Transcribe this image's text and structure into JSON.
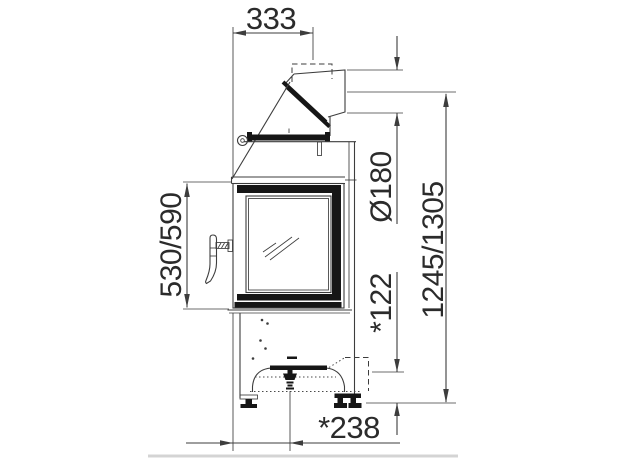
{
  "drawing": {
    "dimensions": {
      "flue_offset_width": "333",
      "flue_diameter": "Ø180",
      "overall_height": "1245/1305",
      "door_glass_height": "530/590",
      "air_intake_height": "*122",
      "air_intake_depth": "*238"
    },
    "colors": {
      "line": "#3d3d3d",
      "solid_fill": "#161616",
      "text": "#2b2b2b",
      "background": "#ffffff"
    }
  }
}
